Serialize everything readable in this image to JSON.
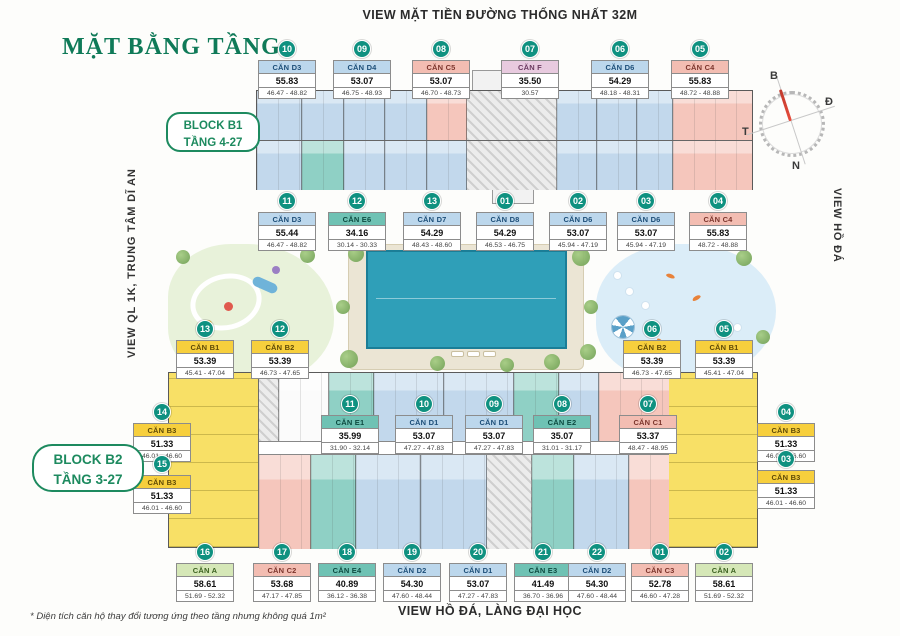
{
  "page": {
    "top_view_label": "VIEW MẶT TIỀN ĐƯỜNG THỐNG NHẤT 32M",
    "main_title": "MẶT BẰNG TẦNG",
    "left_view_label": "VIEW QL 1K, TRUNG TÂM DĨ AN",
    "right_view_label": "VIEW HỒ ĐÁ",
    "bottom_view_label": "VIEW HỒ ĐÁ, LÀNG ĐẠI HỌC",
    "footnote": "* Diện tích căn hộ thay đổi tương ứng theo tầng nhưng không quá 1m²",
    "block_b1_label": {
      "line1": "BLOCK B1",
      "line2": "TẦNG 4-27"
    },
    "block_b2_label": {
      "line1": "BLOCK B2",
      "line2": "TẦNG 3-27"
    },
    "compass": {
      "n": "B",
      "e": "Đ",
      "w": "T",
      "s": "N"
    }
  },
  "colors": {
    "title_green": "#0f7a58",
    "badge_teal": "#0f9180",
    "type_D_blue": "#bcd7ec",
    "type_C_pink": "#f3bdb2",
    "type_E_teal": "#6fc2b4",
    "type_B_yellow": "#f7cf3d",
    "type_A_green": "#d5e7b7",
    "type_F_lavender": "#e8cadf",
    "pool_blue": "#2f9fb8"
  },
  "units": [
    {
      "badge": "10",
      "name": "CĂN D3",
      "area": "55.83",
      "range": "46.47 - 48.82",
      "type": "D",
      "x": 287,
      "y": 40
    },
    {
      "badge": "09",
      "name": "CĂN D4",
      "area": "53.07",
      "range": "46.75 - 48.93",
      "type": "D",
      "x": 362,
      "y": 40
    },
    {
      "badge": "08",
      "name": "CĂN C5",
      "area": "53.07",
      "range": "46.70 - 48.73",
      "type": "C",
      "x": 441,
      "y": 40
    },
    {
      "badge": "07",
      "name": "CĂN F",
      "area": "35.50",
      "range": "30.57",
      "type": "F",
      "x": 530,
      "y": 40
    },
    {
      "badge": "06",
      "name": "CĂN D6",
      "area": "54.29",
      "range": "48.18 - 48.31",
      "type": "D",
      "x": 620,
      "y": 40
    },
    {
      "badge": "05",
      "name": "CĂN C4",
      "area": "55.83",
      "range": "48.72 - 48.88",
      "type": "C",
      "x": 700,
      "y": 40
    },
    {
      "badge": "11",
      "name": "CĂN D3",
      "area": "55.44",
      "range": "46.47 - 48.82",
      "type": "D",
      "x": 287,
      "y": 192
    },
    {
      "badge": "12",
      "name": "CĂN E6",
      "area": "34.16",
      "range": "30.14 - 30.33",
      "type": "E",
      "x": 357,
      "y": 192
    },
    {
      "badge": "13",
      "name": "CĂN D7",
      "area": "54.29",
      "range": "48.43 - 48.60",
      "type": "D",
      "x": 432,
      "y": 192
    },
    {
      "badge": "01",
      "name": "CĂN D8",
      "area": "54.29",
      "range": "46.53 - 46.75",
      "type": "D",
      "x": 505,
      "y": 192
    },
    {
      "badge": "02",
      "name": "CĂN D6",
      "area": "53.07",
      "range": "45.94 - 47.19",
      "type": "D",
      "x": 578,
      "y": 192
    },
    {
      "badge": "03",
      "name": "CĂN D6",
      "area": "53.07",
      "range": "45.94 - 47.19",
      "type": "D",
      "x": 646,
      "y": 192
    },
    {
      "badge": "04",
      "name": "CĂN C4",
      "area": "55.83",
      "range": "48.72 - 48.88",
      "type": "C",
      "x": 718,
      "y": 192
    },
    {
      "badge": "13",
      "name": "CĂN B1",
      "area": "53.39",
      "range": "45.41 - 47.04",
      "type": "B",
      "x": 205,
      "y": 320
    },
    {
      "badge": "12",
      "name": "CĂN B2",
      "area": "53.39",
      "range": "46.73 - 47.65",
      "type": "B",
      "x": 280,
      "y": 320
    },
    {
      "badge": "06",
      "name": "CĂN B2",
      "area": "53.39",
      "range": "46.73 - 47.65",
      "type": "B",
      "x": 652,
      "y": 320
    },
    {
      "badge": "05",
      "name": "CĂN B1",
      "area": "53.39",
      "range": "45.41 - 47.04",
      "type": "B",
      "x": 724,
      "y": 320
    },
    {
      "badge": "11",
      "name": "CĂN E1",
      "area": "35.99",
      "range": "31.90 - 32.14",
      "type": "E",
      "x": 350,
      "y": 395
    },
    {
      "badge": "10",
      "name": "CĂN D1",
      "area": "53.07",
      "range": "47.27 - 47.83",
      "type": "D",
      "x": 424,
      "y": 395
    },
    {
      "badge": "09",
      "name": "CĂN D1",
      "area": "53.07",
      "range": "47.27 - 47.83",
      "type": "D",
      "x": 494,
      "y": 395
    },
    {
      "badge": "08",
      "name": "CĂN E2",
      "area": "35.07",
      "range": "31.01 - 31.17",
      "type": "E",
      "x": 562,
      "y": 395
    },
    {
      "badge": "07",
      "name": "CĂN C1",
      "area": "53.37",
      "range": "48.47 - 48.95",
      "type": "C",
      "x": 648,
      "y": 395
    },
    {
      "badge": "14",
      "name": "CĂN B3",
      "area": "51.33",
      "range": "46.01 - 46.60",
      "type": "B",
      "x": 162,
      "y": 403
    },
    {
      "badge": "15",
      "name": "CĂN B3",
      "area": "51.33",
      "range": "46.01 - 46.60",
      "type": "B",
      "x": 162,
      "y": 455
    },
    {
      "badge": "04",
      "name": "CĂN B3",
      "area": "51.33",
      "range": "46.01 - 46.60",
      "type": "B",
      "x": 786,
      "y": 403
    },
    {
      "badge": "03",
      "name": "CĂN B3",
      "area": "51.33",
      "range": "46.01 - 46.60",
      "type": "B",
      "x": 786,
      "y": 450
    },
    {
      "badge": "16",
      "name": "CĂN A",
      "area": "58.61",
      "range": "51.69 - 52.32",
      "type": "A",
      "x": 205,
      "y": 543
    },
    {
      "badge": "17",
      "name": "CĂN C2",
      "area": "53.68",
      "range": "47.17 - 47.85",
      "type": "C",
      "x": 282,
      "y": 543
    },
    {
      "badge": "18",
      "name": "CĂN E4",
      "area": "40.89",
      "range": "36.12 - 36.38",
      "type": "E",
      "x": 347,
      "y": 543
    },
    {
      "badge": "19",
      "name": "CĂN D2",
      "area": "54.30",
      "range": "47.60 - 48.44",
      "type": "D",
      "x": 412,
      "y": 543
    },
    {
      "badge": "20",
      "name": "CĂN D1",
      "area": "53.07",
      "range": "47.27 - 47.83",
      "type": "D",
      "x": 478,
      "y": 543
    },
    {
      "badge": "21",
      "name": "CĂN E3",
      "area": "41.49",
      "range": "36.70 - 36.96",
      "type": "E",
      "x": 543,
      "y": 543
    },
    {
      "badge": "22",
      "name": "CĂN D2",
      "area": "54.30",
      "range": "47.60 - 48.44",
      "type": "D",
      "x": 597,
      "y": 543
    },
    {
      "badge": "01",
      "name": "CĂN C3",
      "area": "52.78",
      "range": "46.60 - 47.28",
      "type": "C",
      "x": 660,
      "y": 543
    },
    {
      "badge": "02",
      "name": "CĂN A",
      "area": "58.61",
      "range": "51.69 - 52.32",
      "type": "A",
      "x": 724,
      "y": 543
    }
  ]
}
